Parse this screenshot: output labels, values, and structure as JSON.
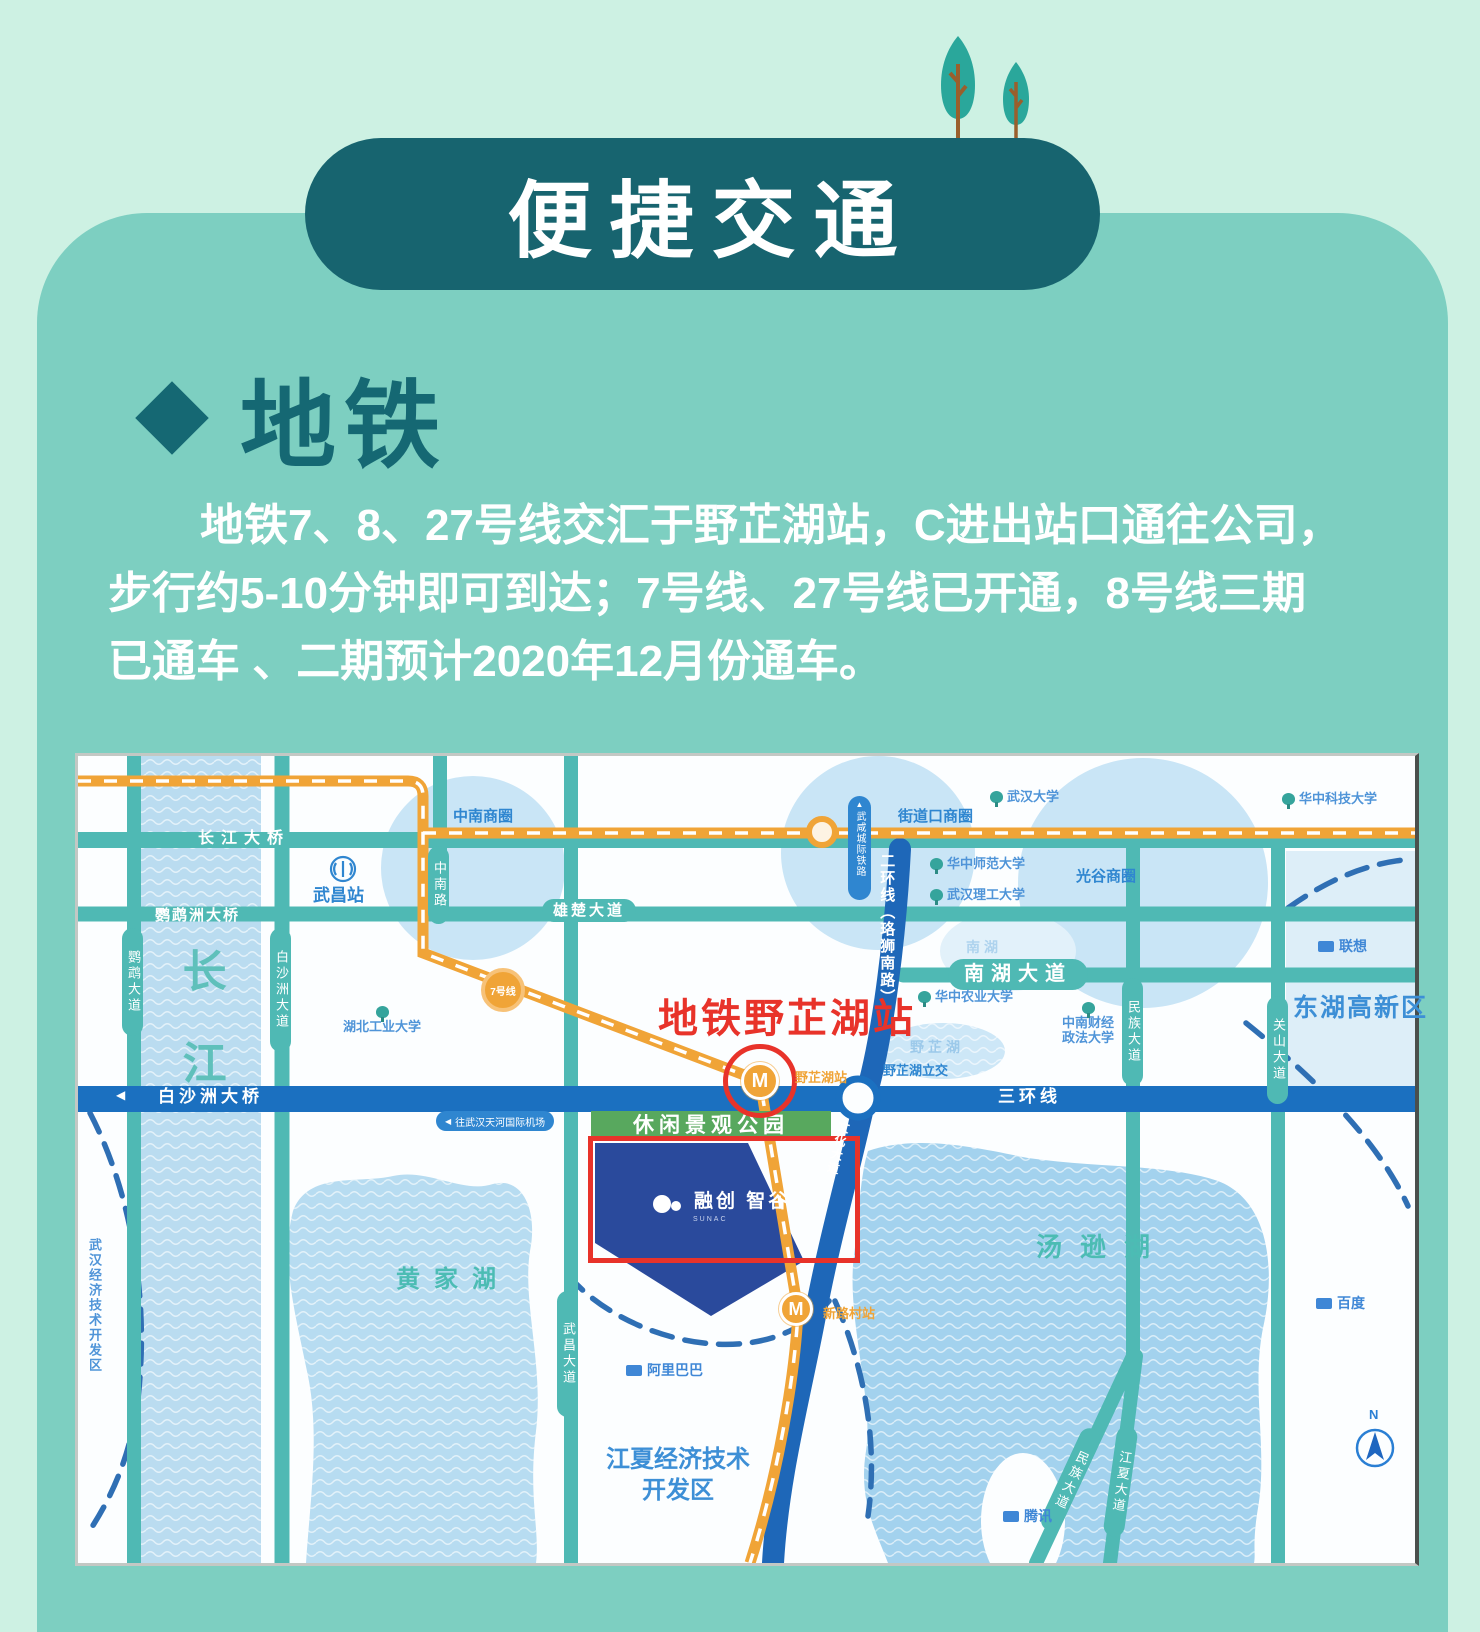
{
  "banner": {
    "title": "便捷交通"
  },
  "section": {
    "heading": "地铁",
    "para_line1": "地铁7、8、27号线交汇于野芷湖站，C进出站口通往公司，",
    "para_line2": "步行约5-10分钟即可到达；7号线、27号线已开通，8号线三期",
    "para_line3": "已通车 、二期预计2020年12月份通车。"
  },
  "map": {
    "labels": {
      "changjiang": "长江",
      "changjiang_bridge": "长江大桥",
      "yingwuzhou_bridge": "鹦鹉洲大桥",
      "yingwu_ave": "鹦鹉大道",
      "baishazhou_ave": "白沙洲大道",
      "zhongnan_road": "中南路",
      "xiongchu_ave": "雄楚大道",
      "wuchang_station": "武昌站",
      "zhongnan_biz": "中南商圈",
      "jiedaokou_biz": "街道口商圈",
      "guanggu_biz": "光谷商圈",
      "wuhan_univ": "武汉大学",
      "huazhong_normal_univ": "华中师范大学",
      "wuhan_tech_univ": "武汉理工大学",
      "huazhong_sci_univ": "华中科技大学",
      "huazhong_agri_univ": "华中农业大学",
      "zhongnan_univ": "中南财经\n政法大学",
      "hubei_tech_univ": "湖北工业大学",
      "lenovo": "联想",
      "baidu": "百度",
      "alibaba": "阿里巴巴",
      "tencent": "腾讯",
      "nanhu": "南湖",
      "nanhu_ave": "南湖大道",
      "minzu_ave": "民族大道",
      "guanshan_ave": "关山大道",
      "donghu_hitech": "东湖高新区",
      "erhuan": "二环线（珞狮南路）",
      "rail_capsule": "武咸城际铁路",
      "line7_badge": "7号线",
      "metro_yezhihu_red": "地铁野芷湖站",
      "yezhihu_station": "野芷湖站",
      "yezhihu_interchange": "野芷湖立交",
      "yezhihu_lake": "野芷湖",
      "sanhuan": "三环线",
      "baishazhou_bridge": "白沙洲大桥",
      "airport": "往武汉天河国际机场",
      "airport_arrow": "◀",
      "leisure_park": "休闲景观公园",
      "sunac_zh": "融创 智谷",
      "sunac_en": "SUNAC",
      "wenhua_ave": "文化大道",
      "tangxun_lake": "汤逊湖",
      "huangjia_lake": "黄家湖",
      "wuhan_dev_zone": "武汉经济技术开发区",
      "wuchang_ave": "武昌大道",
      "jiangxia_dev_zone": "江夏经济技术\n开发区",
      "xinlucun_station": "新路村站",
      "minzu_ave_south": "民族大道",
      "jiangxia_ave": "江夏大道",
      "m_badge": "M",
      "compass_n": "N"
    },
    "theme": {
      "page_bg": "#cdf1e3",
      "panel_bg": "#7dcfc1",
      "banner_bg": "#17646f",
      "heading_color": "#156873",
      "road_teal": "#4fb9b4",
      "highway_blue": "#1b70c0",
      "metro_orange": "#f0a437",
      "alert_red": "#e8332a",
      "site_navy": "#2a4a9c",
      "park_green": "#58a85e"
    }
  }
}
